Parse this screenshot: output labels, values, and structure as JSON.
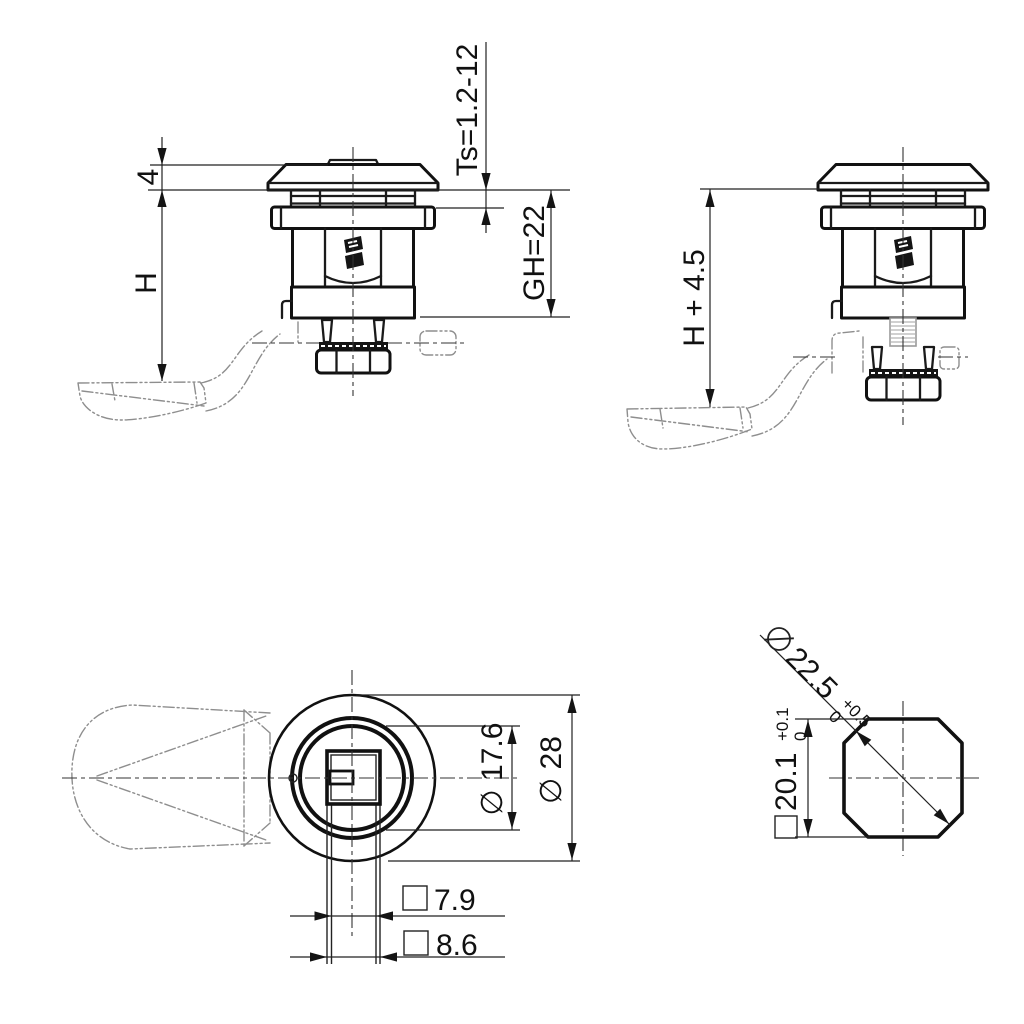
{
  "drawing": {
    "colors": {
      "ink": "#111111",
      "phantom": "#8e8e8e",
      "background": "#ffffff"
    },
    "views": {
      "side_compressed": {
        "dims": {
          "head_height": "4",
          "height_h": "H",
          "panel_thickness": "Ts=1.2-12",
          "grip_height": "GH=22"
        }
      },
      "side_extended": {
        "dims": {
          "height_total": "H + 4.5"
        }
      },
      "top": {
        "dims": {
          "flange_diameter": "∅ 17.6",
          "head_diameter": "∅ 28",
          "square_inner": {
            "symbol": "□",
            "value": "7.9"
          },
          "square_outer": {
            "symbol": "□",
            "value": "8.6"
          }
        }
      },
      "cutout": {
        "dims": {
          "diagonal": {
            "symbol": "∅",
            "value": "22.5",
            "tol_upper": "+0.5",
            "tol_lower": "0"
          },
          "width": {
            "symbol": "□",
            "value": "20.1",
            "tol_upper": "+0.1",
            "tol_lower": "0"
          }
        }
      }
    }
  }
}
